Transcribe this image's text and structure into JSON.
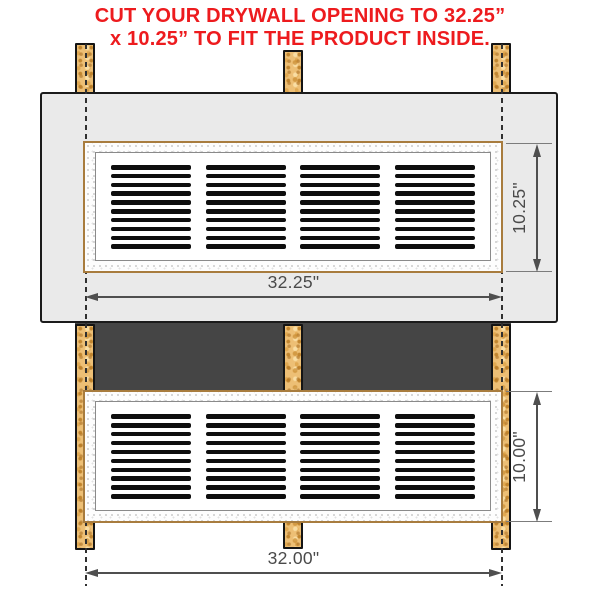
{
  "title": {
    "line1": "CUT YOUR DRYWALL OPENING TO 32.25”",
    "line2": "x 10.25” TO FIT THE PRODUCT INSIDE."
  },
  "top_view": {
    "description": "drywall-opening-view",
    "width_dim": "32.25\"",
    "height_dim": "10.25\"",
    "grille": {
      "groups": 4,
      "slats_per_group": 10
    }
  },
  "bottom_view": {
    "description": "stud-frame-product-view",
    "width_dim": "32.00\"",
    "height_dim": "10.00\"",
    "grille": {
      "groups": 4,
      "slats_per_group": 10
    }
  },
  "colors": {
    "accent_red": "#ed1b1e",
    "drywall": "#eaeaea",
    "wall_cavity": "#454545",
    "stud_wood": "#edbf75",
    "slat_black": "#0e0e0e",
    "dim_line": "#4f4f4f",
    "grille_trim": "#a87c3e"
  }
}
